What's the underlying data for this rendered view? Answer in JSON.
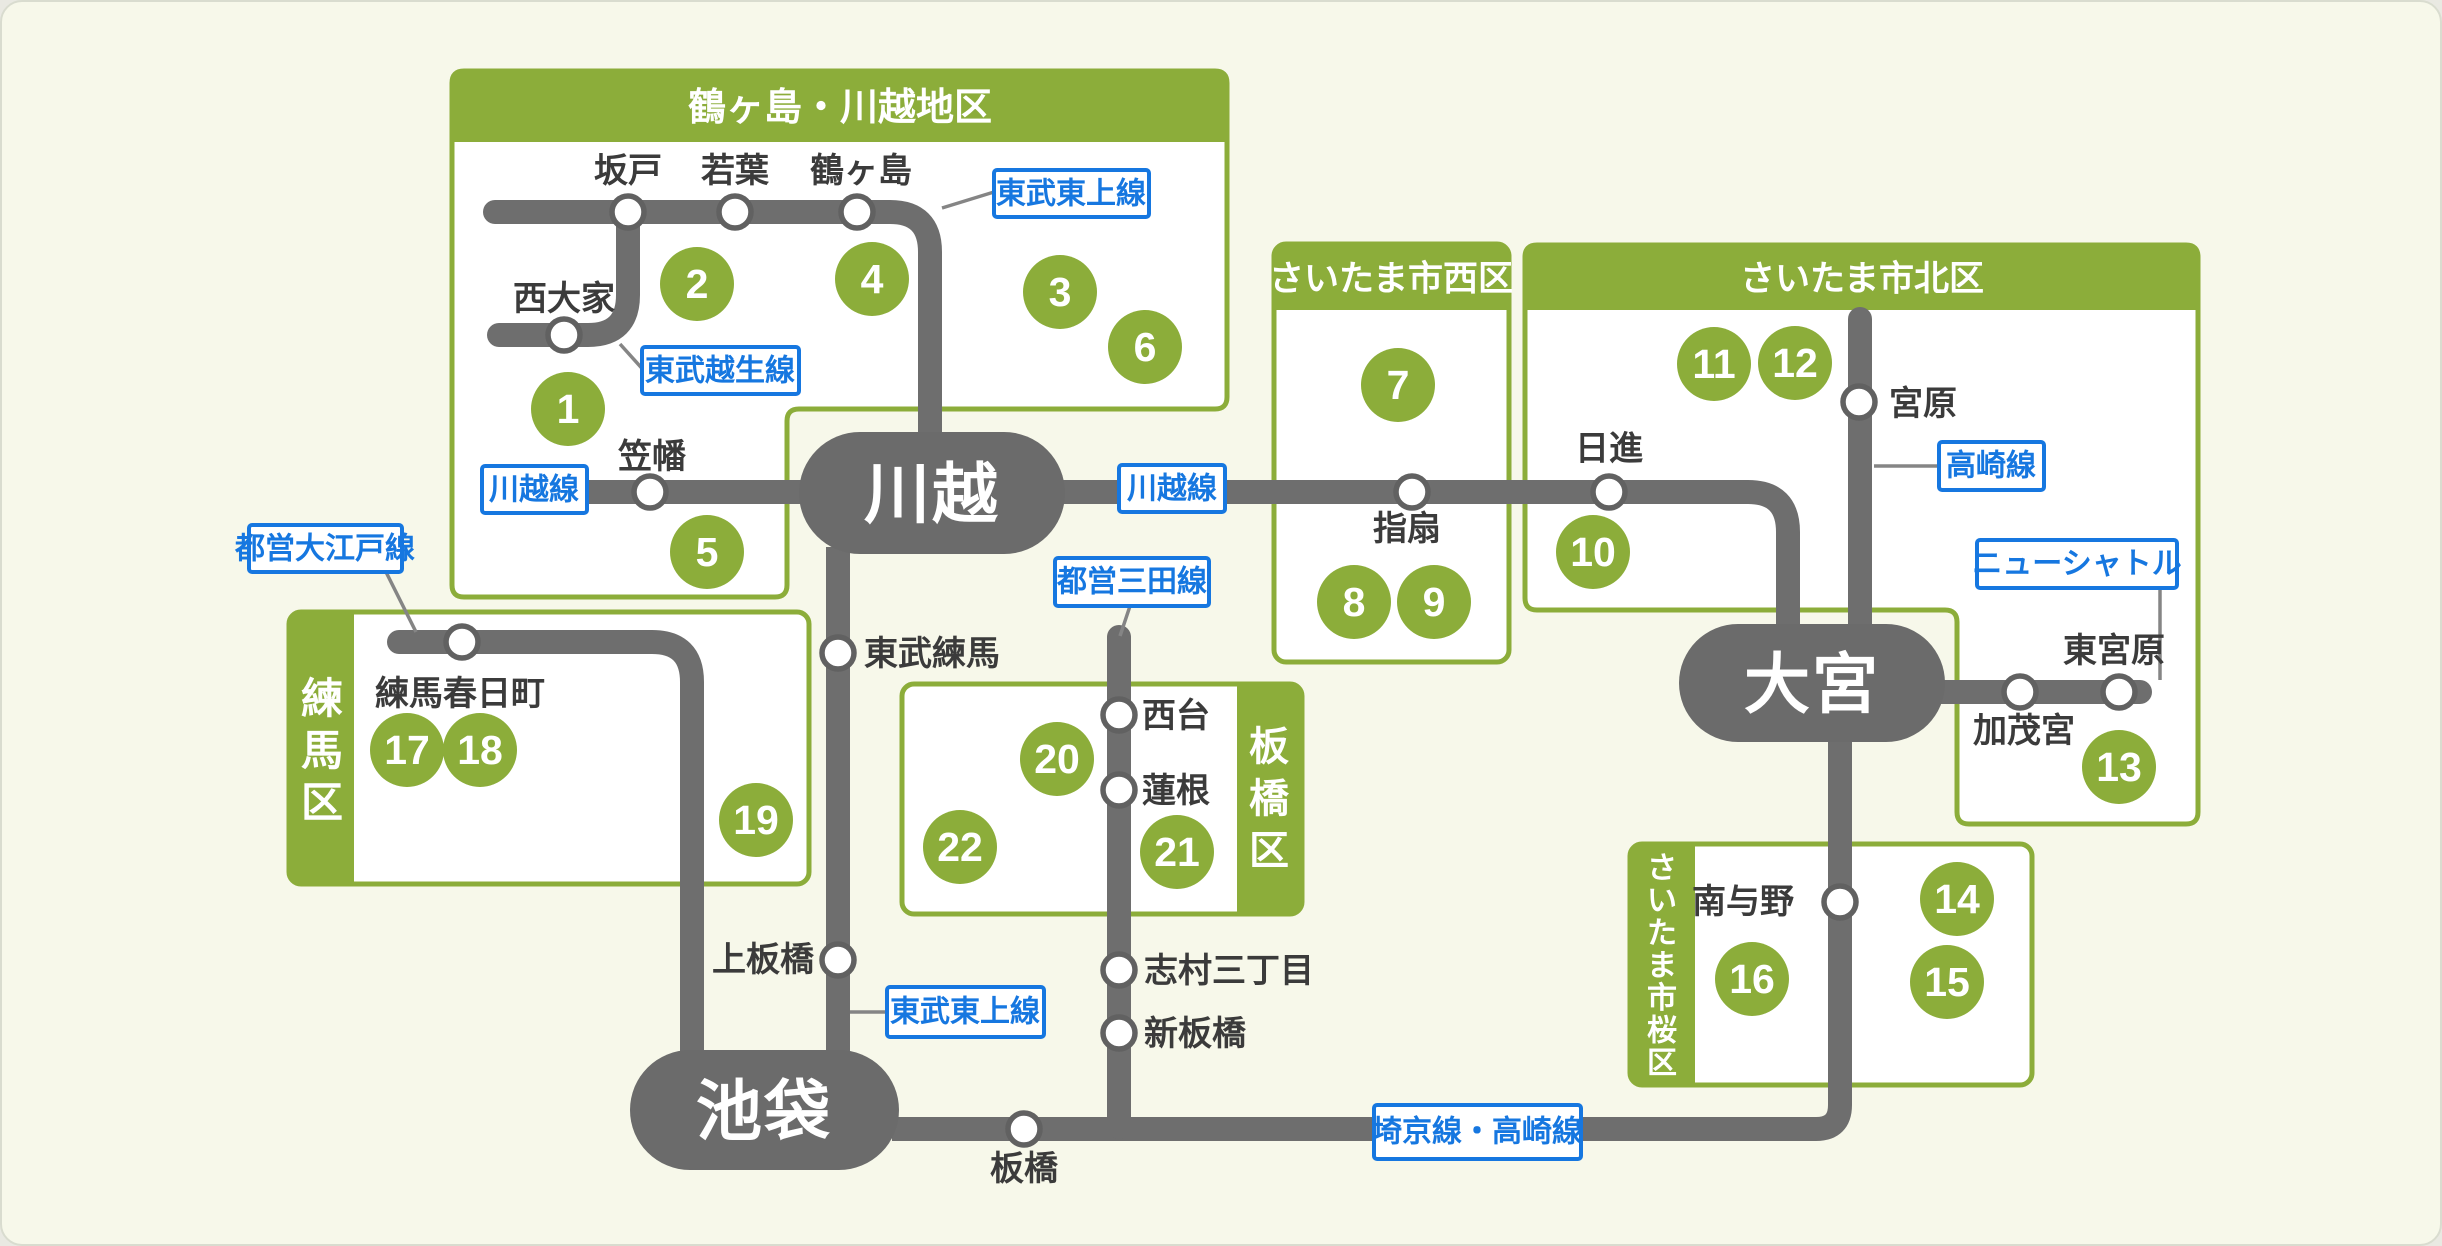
{
  "colors": {
    "background": "#F7F8EA",
    "region_green": "#8CAD3A",
    "rail_gray": "#6E6E6E",
    "hub_gray": "#6B6B6B",
    "label_blue": "#1677E0",
    "station_text": "#3B3B3B"
  },
  "regions": [
    {
      "title": "鶴ヶ島・川越地区"
    },
    {
      "title": "さいたま市西区"
    },
    {
      "title": "さいたま市北区"
    },
    {
      "title": "練馬区"
    },
    {
      "title": "板橋区"
    },
    {
      "title": "さいたま市桜区"
    }
  ],
  "hubs": [
    {
      "label": "川越"
    },
    {
      "label": "大宮"
    },
    {
      "label": "池袋"
    }
  ],
  "line_labels": [
    {
      "label": "東武東上線"
    },
    {
      "label": "東武越生線"
    },
    {
      "label": "川越線"
    },
    {
      "label": "川越線"
    },
    {
      "label": "高崎線"
    },
    {
      "label": "ニューシャトル"
    },
    {
      "label": "都営大江戸線"
    },
    {
      "label": "都営三田線"
    },
    {
      "label": "東武東上線"
    },
    {
      "label": "埼京線・高崎線"
    }
  ],
  "stations": [
    {
      "label": "坂戸"
    },
    {
      "label": "若葉"
    },
    {
      "label": "鶴ヶ島"
    },
    {
      "label": "西大家"
    },
    {
      "label": "笠幡"
    },
    {
      "label": "指扇"
    },
    {
      "label": "日進"
    },
    {
      "label": "宮原"
    },
    {
      "label": "加茂宮"
    },
    {
      "label": "東宮原"
    },
    {
      "label": "練馬春日町"
    },
    {
      "label": "東武練馬"
    },
    {
      "label": "上板橋"
    },
    {
      "label": "西台"
    },
    {
      "label": "蓮根"
    },
    {
      "label": "志村三丁目"
    },
    {
      "label": "新板橋"
    },
    {
      "label": "板橋"
    },
    {
      "label": "南与野"
    }
  ],
  "markers": [
    "1",
    "2",
    "3",
    "4",
    "5",
    "6",
    "7",
    "8",
    "9",
    "10",
    "11",
    "12",
    "13",
    "14",
    "15",
    "16",
    "17",
    "18",
    "19",
    "20",
    "21",
    "22"
  ]
}
